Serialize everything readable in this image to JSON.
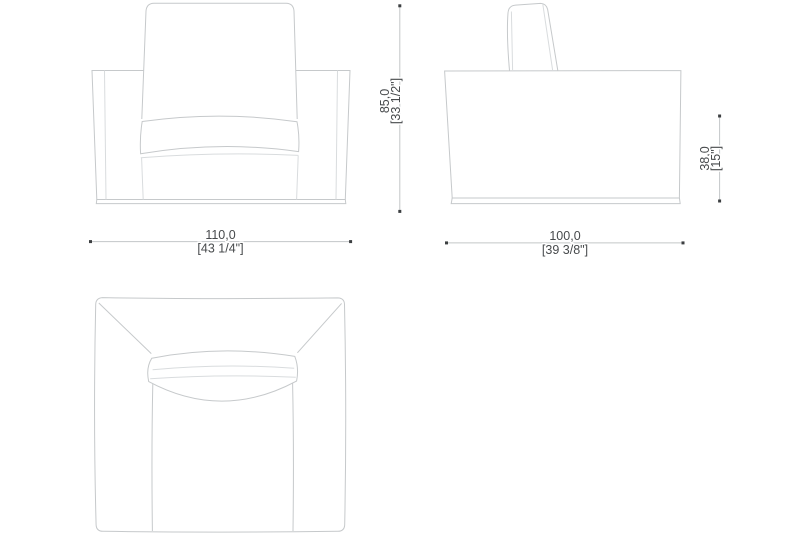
{
  "colors": {
    "background": "#ffffff",
    "outline": "#c6c9cb",
    "detail": "#d9dcde",
    "dimension-line": "#c3c6c8",
    "marker": "#3c3f41",
    "text": "#474a4c"
  },
  "dimensions": {
    "front_width": {
      "cm": "110,0",
      "inches": "[43 1/4\"]"
    },
    "overall_height": {
      "cm": "85,0",
      "inches": "[33 1/2\"]"
    },
    "depth": {
      "cm": "100,0",
      "inches": "[39 3/8\"]"
    },
    "seat_height": {
      "cm": "38,0",
      "inches": "[15\"]"
    }
  }
}
